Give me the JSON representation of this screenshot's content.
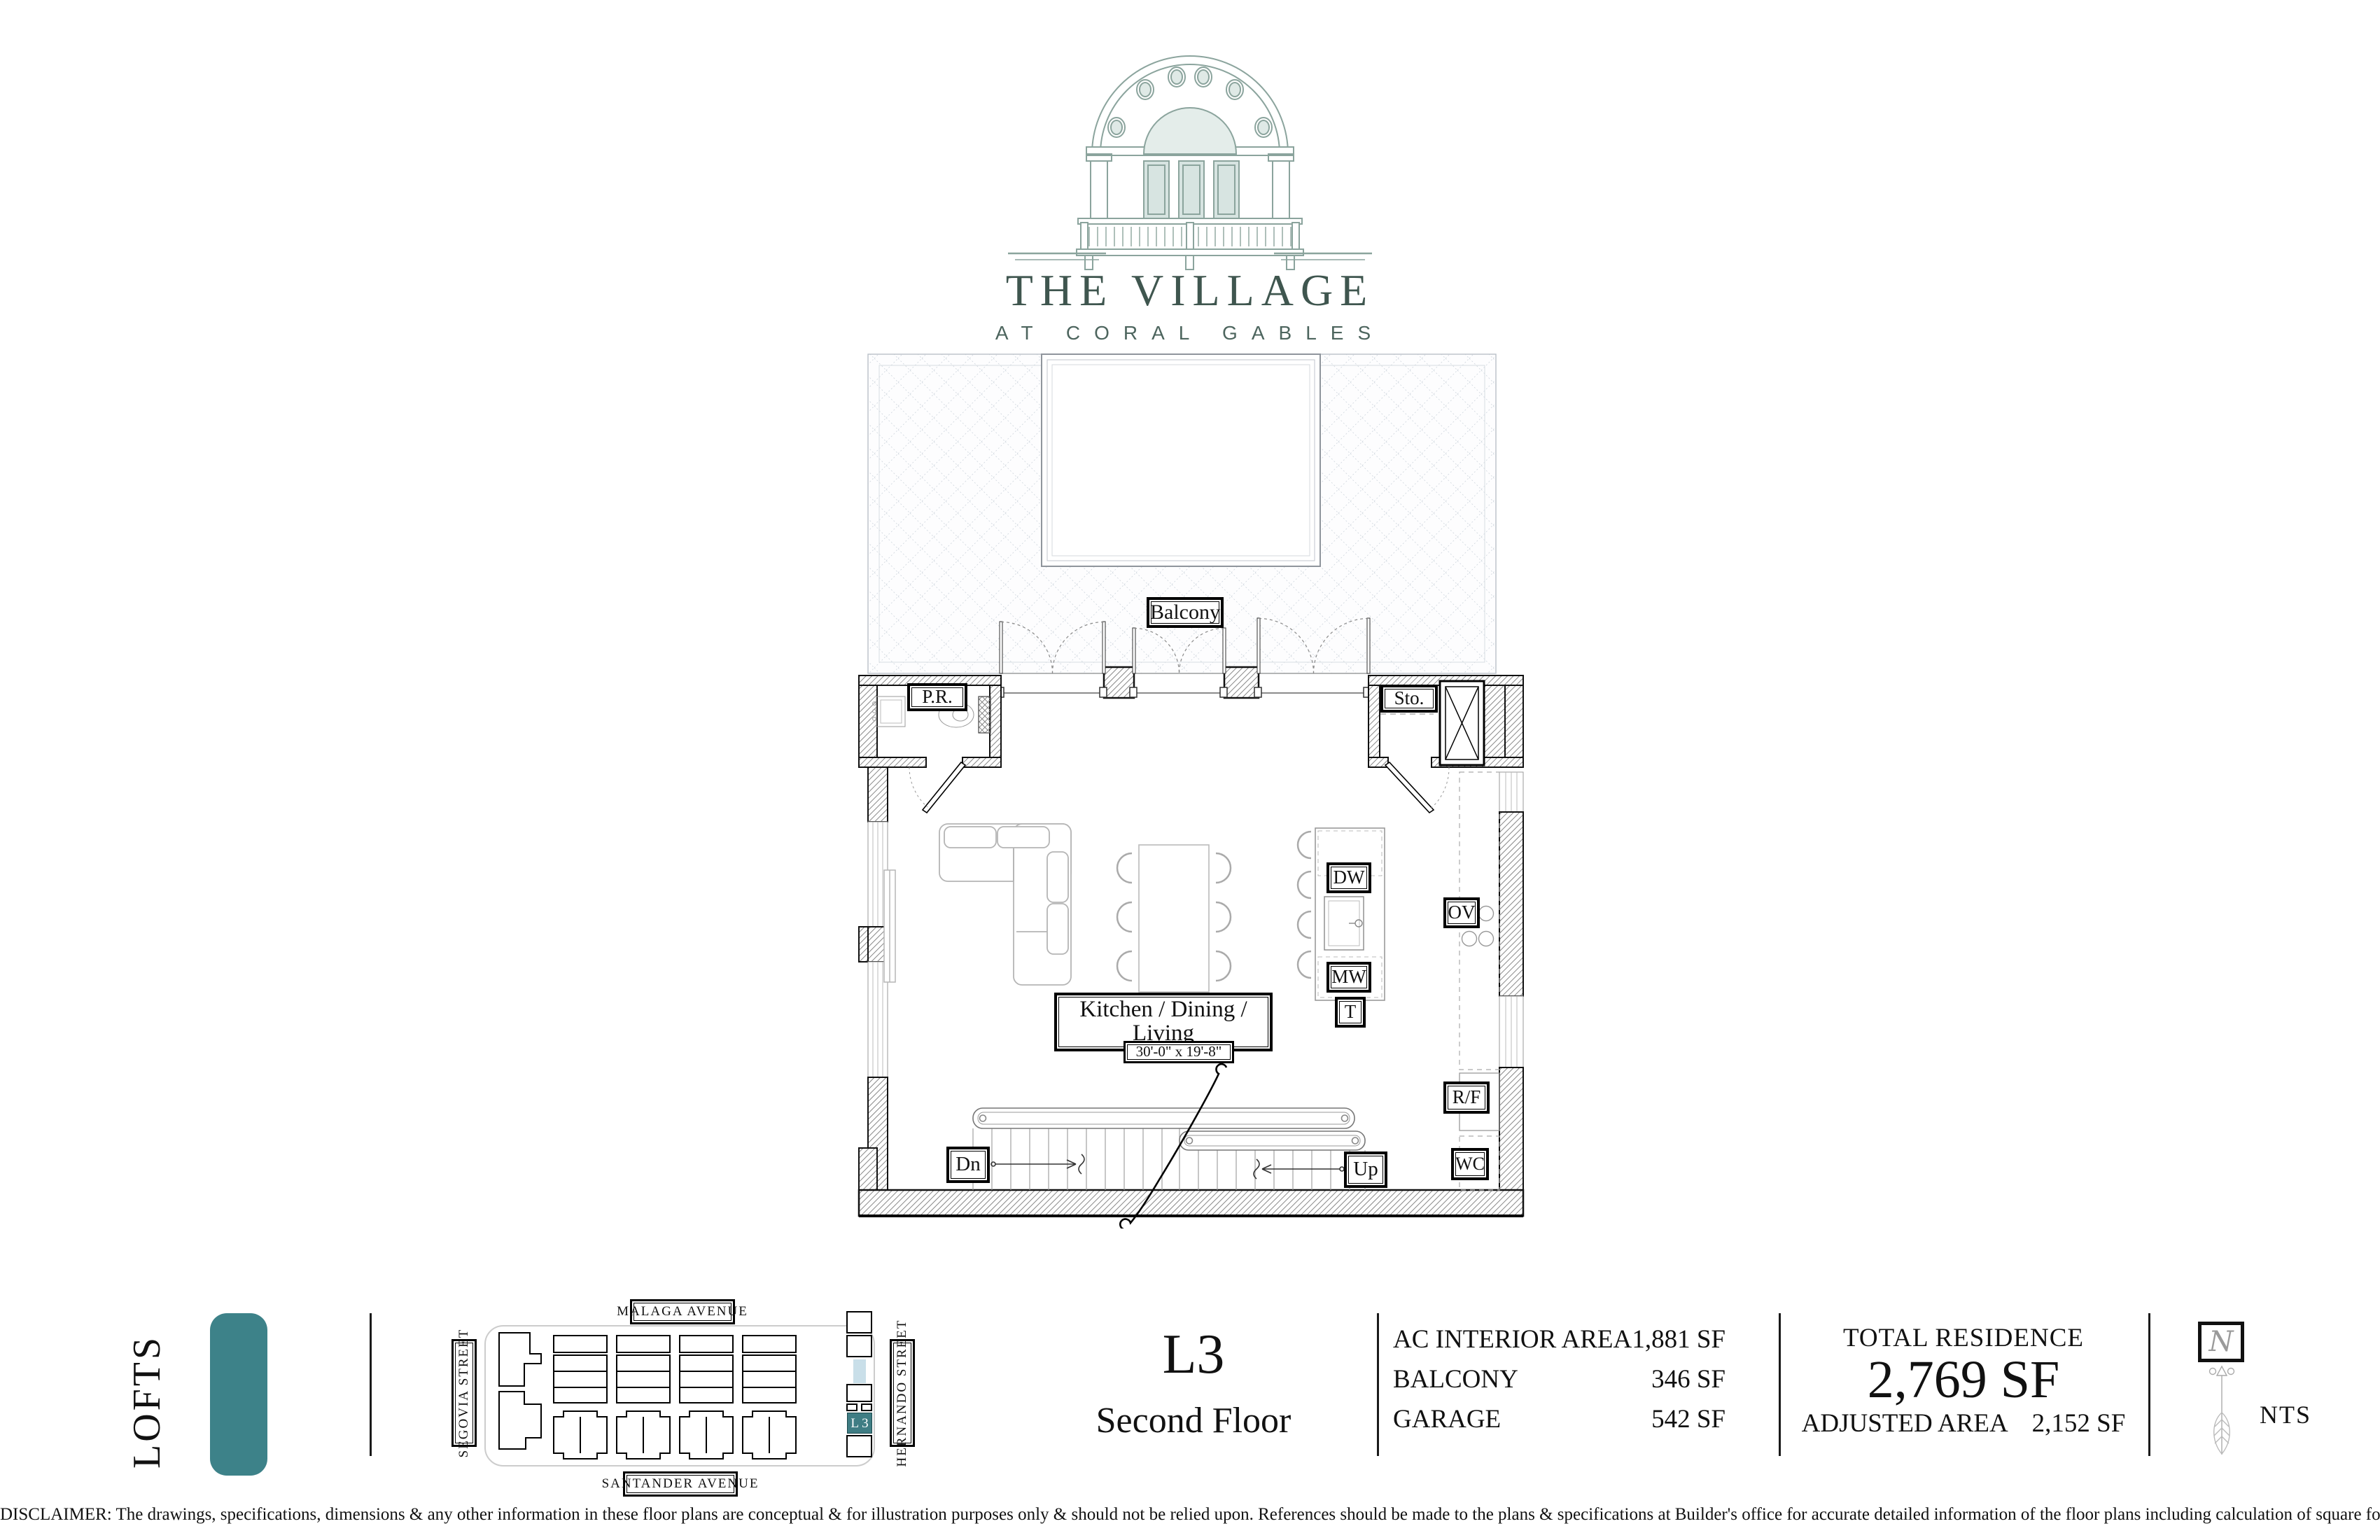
{
  "brand": {
    "title": "THE VILLAGE",
    "tagline": "AT CORAL GABLES",
    "color": "#3f564f"
  },
  "plan": {
    "labels": {
      "balcony": "Balcony",
      "powder_room": "P.R.",
      "storage": "Sto.",
      "kitchen_line1": "Kitchen / Dining /",
      "kitchen_line2": "Living",
      "dimensions": "30'-0\" x 19'-8\"",
      "dishwasher": "DW",
      "oven": "OV",
      "microwave": "MW",
      "trash": "T",
      "fridge": "R/F",
      "water_closet": "WC",
      "stairs_down": "Dn",
      "stairs_up": "Up"
    }
  },
  "footer": {
    "series_label": "LOFTS",
    "accent_color": "#3d8289",
    "sitemap": {
      "streets": {
        "top": "MALAGA AVENUE",
        "left": "SEGOVIA STREET",
        "bottom": "SANTANDER AVENUE",
        "right": "HERNANDO STREET"
      },
      "unit_label": "L 3",
      "unit_color": "#3f7d84",
      "pool_color": "#c9dfe9"
    },
    "unit": {
      "model": "L3",
      "floor": "Second Floor"
    },
    "areas": {
      "rows": [
        {
          "label": "AC INTERIOR AREA",
          "value": "1,881 SF"
        },
        {
          "label": "BALCONY",
          "value": "346 SF"
        },
        {
          "label": "GARAGE",
          "value": "542 SF"
        }
      ]
    },
    "totals": {
      "title": "TOTAL RESIDENCE",
      "value": "2,769 SF",
      "adjusted_label": "ADJUSTED AREA",
      "adjusted_value": "2,152 SF"
    },
    "scale_label": "NTS",
    "compass_letter": "N"
  },
  "disclaimer": "DISCLAIMER: The drawings, specifications, dimensions & any other information in these floor plans are conceptual & for illustration purposes only & should not be relied upon. References should be made to the plans & specifications at Builder's office for accurate detailed information of the floor plans including calculation of square footage, dimension & other information."
}
